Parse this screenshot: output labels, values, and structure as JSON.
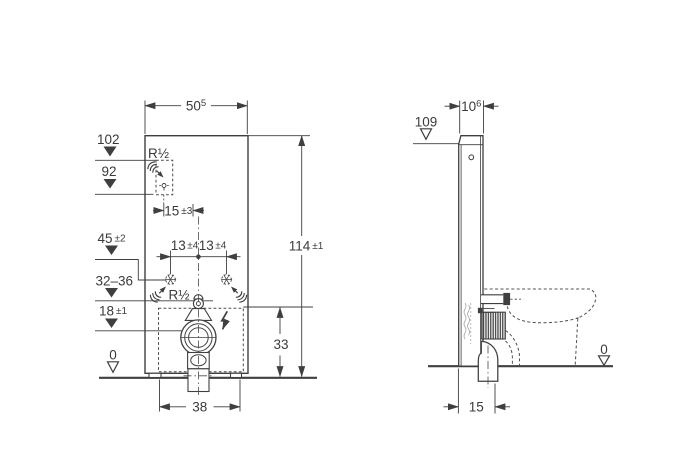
{
  "drawing": {
    "type": "technical-dimension-drawing",
    "views": [
      "front",
      "side"
    ],
    "unit_system": "cm"
  },
  "front": {
    "width": {
      "main": "50",
      "sup": "5"
    },
    "height": {
      "main": "114",
      "tol": "±1"
    },
    "level_102": "102",
    "level_92": "92",
    "level_45": {
      "main": "45",
      "tol": "±2"
    },
    "level_32_36": "32–36",
    "level_18": {
      "main": "18",
      "tol": "±1"
    },
    "level_0": "0",
    "tap_offset": {
      "main": "15",
      "tol": "±3"
    },
    "anchor_left": {
      "main": "13",
      "tol": "±4"
    },
    "anchor_right": {
      "main": "13",
      "tol": "±4"
    },
    "service_height": "33",
    "base_width": "38",
    "supply_top_label": "R½",
    "supply_mid_label": "R½"
  },
  "side": {
    "depth": {
      "main": "10",
      "sup": "6"
    },
    "back_height": "109",
    "level_0": "0",
    "outlet_offset": "15"
  },
  "colors": {
    "line": "#3f3f3f",
    "text": "#3b3b3b",
    "background": "#ffffff"
  }
}
